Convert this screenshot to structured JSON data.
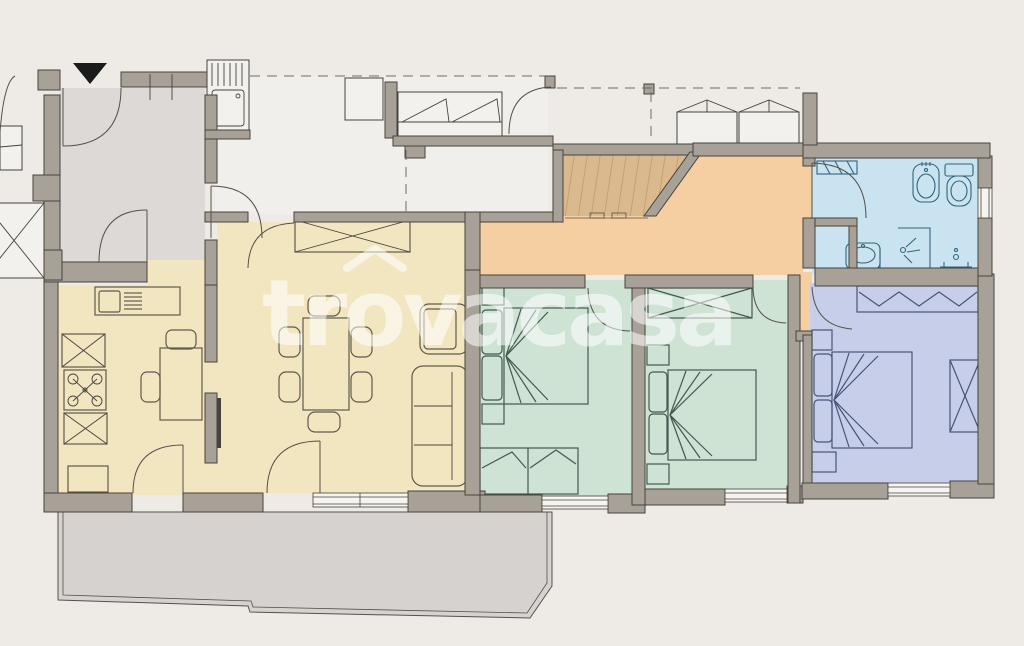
{
  "image": {
    "kind": "apartment-floor-plan",
    "width": 1024,
    "height": 646
  },
  "watermark": {
    "text": "trovacasa",
    "part1": "tr",
    "part2": "o",
    "part3": "vacasa",
    "accent": "house-roof-over-o"
  },
  "entrance": {
    "marker": "black-triangle-down-arrow"
  },
  "colors": {
    "paper": "#eeebe7",
    "wall": "#a8a197",
    "line": "#46423d",
    "entry": "#dcd9d6",
    "terrace": "#d6d2cf",
    "loggia": "#f1efeb",
    "living": "#f2e6c1",
    "hall": "#f5cfa1",
    "wood": "#d9b98d",
    "bedroom": "#cfe3d5",
    "master": "#c6cee9",
    "bath": "#c9e3f1"
  },
  "rooms": [
    {
      "id": "entry-hall",
      "floor": "gray"
    },
    {
      "id": "loggia-terrace",
      "floor": "white",
      "features": [
        "laundry sink",
        "outdoor sofa",
        "bench",
        "sun loungers"
      ]
    },
    {
      "id": "kitchen",
      "floor": "yellow",
      "features": [
        "sink counter",
        "stove",
        "fridge",
        "cabinets",
        "table with 2 chairs"
      ]
    },
    {
      "id": "living-dining",
      "floor": "yellow",
      "features": [
        "sideboard",
        "dining table with 6 chairs",
        "sofa",
        "armchair"
      ]
    },
    {
      "id": "wardrobe-nook",
      "floor": "wood"
    },
    {
      "id": "hallway",
      "floor": "orange"
    },
    {
      "id": "bedroom-1",
      "floor": "green",
      "features": [
        "double bed",
        "nightstands",
        "storage bench"
      ]
    },
    {
      "id": "bedroom-2",
      "floor": "green",
      "features": [
        "double bed",
        "nightstands",
        "wardrobe"
      ]
    },
    {
      "id": "master-bedroom",
      "floor": "blue",
      "features": [
        "double bed",
        "nightstands",
        "wardrobe",
        "dresser"
      ]
    },
    {
      "id": "bathroom",
      "floor": "light-blue",
      "features": [
        "bidet",
        "toilet",
        "washbasin",
        "shower"
      ]
    },
    {
      "id": "terrace-bottom",
      "floor": "gray"
    }
  ]
}
